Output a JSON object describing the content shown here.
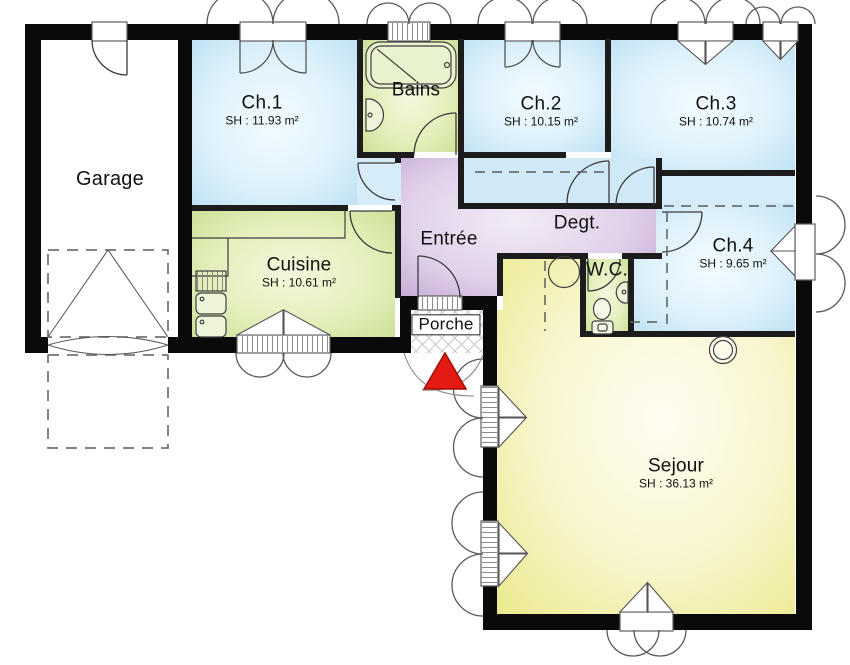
{
  "plan": {
    "title": "Plan de maison (rez-de-chaussée)",
    "rooms": [
      {
        "id": "garage",
        "name": "Garage",
        "area": ""
      },
      {
        "id": "ch1",
        "name": "Ch.1",
        "area": "SH : 11.93 m²"
      },
      {
        "id": "bains",
        "name": "Bains",
        "area": ""
      },
      {
        "id": "ch2",
        "name": "Ch.2",
        "area": "SH : 10.15 m²"
      },
      {
        "id": "ch3",
        "name": "Ch.3",
        "area": "SH : 10.74 m²"
      },
      {
        "id": "cuisine",
        "name": "Cuisine",
        "area": "SH : 10.61 m²"
      },
      {
        "id": "entree",
        "name": "Entrée",
        "area": ""
      },
      {
        "id": "degt",
        "name": "Degt.",
        "area": ""
      },
      {
        "id": "ch4",
        "name": "Ch.4",
        "area": "SH : 9.65 m²"
      },
      {
        "id": "wc",
        "name": "W.C.",
        "area": ""
      },
      {
        "id": "porche",
        "name": "Porche",
        "area": ""
      },
      {
        "id": "sejour",
        "name": "Sejour",
        "area": "SH : 36.13 m²"
      }
    ],
    "colors": {
      "wall": "#0a0a0a",
      "interior_wall": "#1c1c1c",
      "bedroom_blue": "#c3e2f4",
      "service_green": "#d4e49c",
      "hall_purple": "#c6a8d4",
      "living_yellow": "#efec9a",
      "entrance_arrow_red": "#e31b12"
    },
    "icons": [
      "entrance-arrow-icon",
      "window-shutter-arc-icon",
      "door-swing-icon",
      "bathtub-icon",
      "washbasin-icon",
      "toilet-icon",
      "kitchen-sink-icon",
      "garage-driveway-dashed-icon",
      "porch-lattice-icon",
      "stove-column-icon"
    ]
  }
}
